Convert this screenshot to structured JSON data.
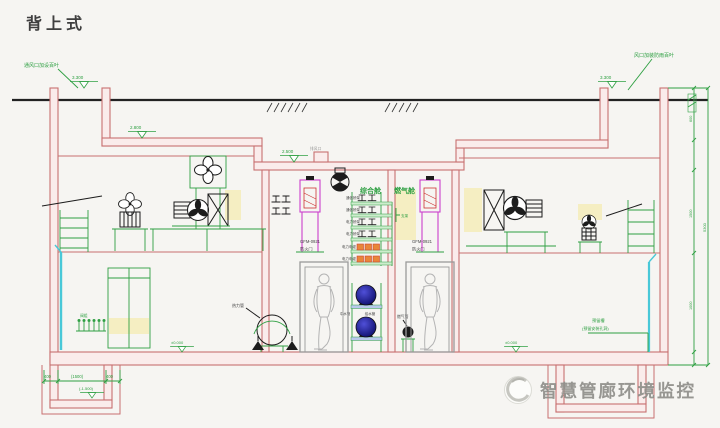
{
  "title": "背上式",
  "watermark": {
    "text": "智慧管廊环境监控"
  },
  "drawing": {
    "compartments": {
      "left": "综合舱",
      "right": "燃气舱"
    },
    "door": {
      "model": "GFM-0921",
      "type": "防火门"
    },
    "tray_rows": [
      "通信桥架",
      "通信桥架",
      "电力桥架",
      "电力桥架",
      "电力电缆",
      "电力电缆"
    ],
    "pipes": {
      "reclaimed": "中水管",
      "water": "给水管",
      "gas": "燃气管",
      "heat": "热力管"
    },
    "bracket_label": "支架",
    "valve_label": "阀组",
    "notes": {
      "vent_left": "通风口加设百叶",
      "vent_right": "风口加装防雨百叶",
      "roof_vent": "排风口",
      "reserve_1": "预留槽",
      "reserve_2": "(预留安装孔洞)"
    },
    "levels": {
      "shaft_left": "3.300",
      "roof_left": "2.800",
      "roof_center": "2.500",
      "shaft_right": "3.300",
      "floor_left": "±0.000",
      "floor_right": "±0.000",
      "pit": "(-1.500)"
    },
    "dims": {
      "pit": [
        "400",
        "(1500)",
        "400"
      ],
      "right_segments": [
        "600",
        "1500",
        "1000"
      ],
      "right_total": "5300"
    }
  },
  "colors": {
    "structure_red": "#c87070",
    "annotation_green": "#2fa043",
    "equipment_magenta": "#cc3fcc",
    "pipe_blue": "#1a1a8c",
    "cable_orange": "#e8873a",
    "highlight_yellow": "#f5e9a8",
    "pipe_cyan": "#49c8d8",
    "watermark_gray": "#8f8f8a"
  }
}
